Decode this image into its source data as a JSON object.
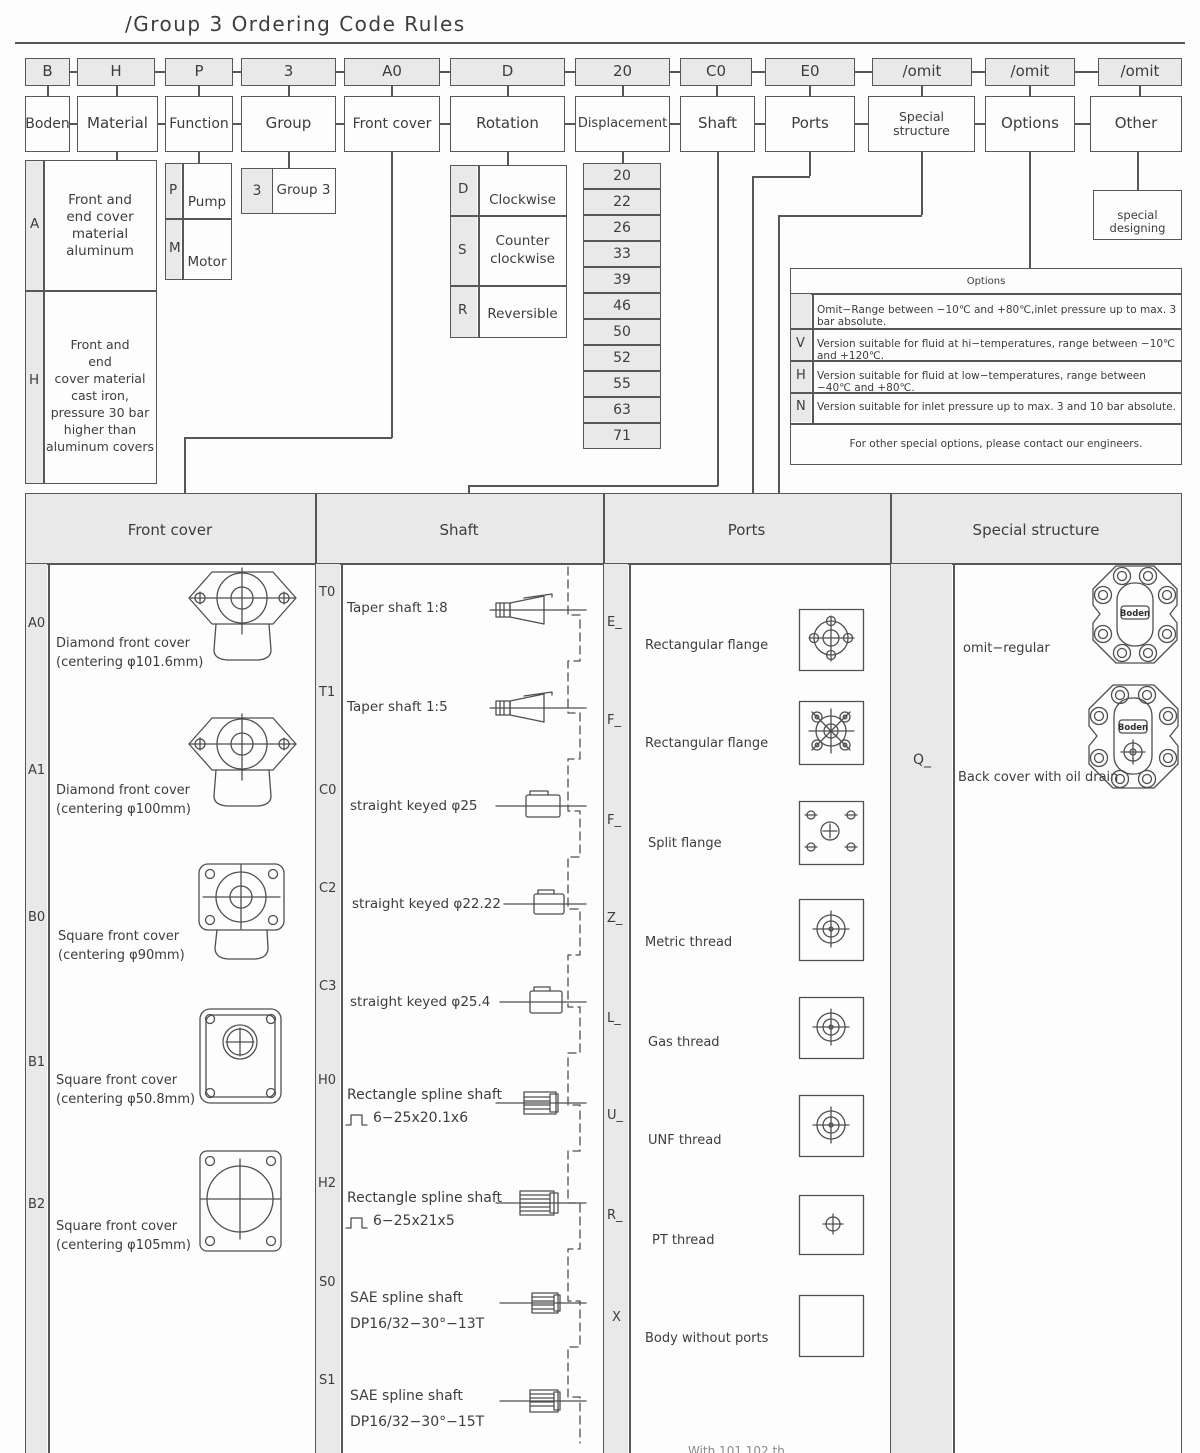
{
  "title": "/Group 3 Ordering Code Rules",
  "brand": "Boden",
  "code_row": [
    "B",
    "H",
    "P",
    "3",
    "A0",
    "D",
    "20",
    "C0",
    "E0",
    "/omit",
    "/omit",
    "/omit"
  ],
  "label_row": [
    "Boden",
    "Material",
    "Function",
    "Group",
    "Front cover",
    "Rotation",
    "Displacement",
    "Shaft",
    "Ports",
    "Special structure",
    "Options",
    "Other"
  ],
  "material": {
    "rows": [
      {
        "code": "A",
        "desc": "Front and\nend cover\nmaterial\naluminum"
      },
      {
        "code": "H",
        "desc": "Front and\nend\ncover material\ncast iron,\npressure 30 bar\nhigher than\naluminum covers"
      }
    ]
  },
  "function": {
    "rows": [
      {
        "code": "P",
        "desc": "Pump"
      },
      {
        "code": "M",
        "desc": "Motor"
      }
    ]
  },
  "group": {
    "rows": [
      {
        "code": "3",
        "desc": "Group 3"
      }
    ]
  },
  "rotation": {
    "rows": [
      {
        "code": "D",
        "desc": "Clockwise"
      },
      {
        "code": "S",
        "desc": "Counter\nclockwise"
      },
      {
        "code": "R",
        "desc": "Reversible"
      }
    ]
  },
  "displacement": {
    "values": [
      "20",
      "22",
      "26",
      "33",
      "39",
      "46",
      "50",
      "52",
      "55",
      "63",
      "71"
    ]
  },
  "special_designing": "special designing",
  "options": {
    "header": "Options",
    "rows": [
      {
        "code": "",
        "desc": "Omit−Range between −10℃ and +80℃,inlet pressure up to max. 3 bar absolute."
      },
      {
        "code": "V",
        "desc": "Version suitable for fluid at hi−temperatures, range between −10℃ and +120℃."
      },
      {
        "code": "H",
        "desc": "Version suitable for fluid at low−temperatures, range between −40℃ and +80℃."
      },
      {
        "code": "N",
        "desc": "Version suitable for inlet pressure up to max. 3 and 10 bar absolute."
      }
    ],
    "footer": "For other special options, please contact our engineers."
  },
  "detail": {
    "headers": [
      "Front cover",
      "Shaft",
      "Ports",
      "Special structure"
    ],
    "front_cover": [
      {
        "code": "A0",
        "text": "Diamond front cover\n(centering φ101.6mm)"
      },
      {
        "code": "A1",
        "text": "Diamond front cover\n(centering φ100mm)"
      },
      {
        "code": "B0",
        "text": "Square front cover\n(centering φ90mm)"
      },
      {
        "code": "B1",
        "text": "Square front cover\n(centering φ50.8mm)"
      },
      {
        "code": "B2",
        "text": "Square front cover\n(centering φ105mm)"
      }
    ],
    "shaft": [
      {
        "code": "T0",
        "line1": "Taper shaft 1:8",
        "line2": ""
      },
      {
        "code": "T1",
        "line1": "Taper shaft 1:5",
        "line2": ""
      },
      {
        "code": "C0",
        "line1": "straight keyed φ25",
        "line2": ""
      },
      {
        "code": "C2",
        "line1": "straight keyed φ22.22",
        "line2": ""
      },
      {
        "code": "C3",
        "line1": "straight keyed φ25.4",
        "line2": ""
      },
      {
        "code": "H0",
        "line1": "Rectangle spline shaft",
        "line2": "6−25x20.1x6"
      },
      {
        "code": "H2",
        "line1": "Rectangle spline shaft",
        "line2": "6−25x21x5"
      },
      {
        "code": "S0",
        "line1": "SAE spline shaft",
        "line2": "DP16/32−30°−13T"
      },
      {
        "code": "S1",
        "line1": "SAE spline shaft",
        "line2": "DP16/32−30°−15T"
      }
    ],
    "ports": [
      {
        "code": "E_",
        "desc": "Rectangular flange"
      },
      {
        "code": "F_",
        "desc": "Rectangular flange"
      },
      {
        "code": "F_",
        "desc": "Split flange"
      },
      {
        "code": "Z_",
        "desc": "Metric thread"
      },
      {
        "code": "L_",
        "desc": "Gas thread"
      },
      {
        "code": "U_",
        "desc": "UNF thread"
      },
      {
        "code": "R_",
        "desc": "PT thread"
      },
      {
        "code": "X",
        "desc": "Body without ports"
      }
    ],
    "special": [
      {
        "code": "",
        "desc": "omit−regular"
      },
      {
        "code": "Q_",
        "desc": "Back cover with oil drain"
      }
    ]
  },
  "cropped_note": "With 101 102 th"
}
